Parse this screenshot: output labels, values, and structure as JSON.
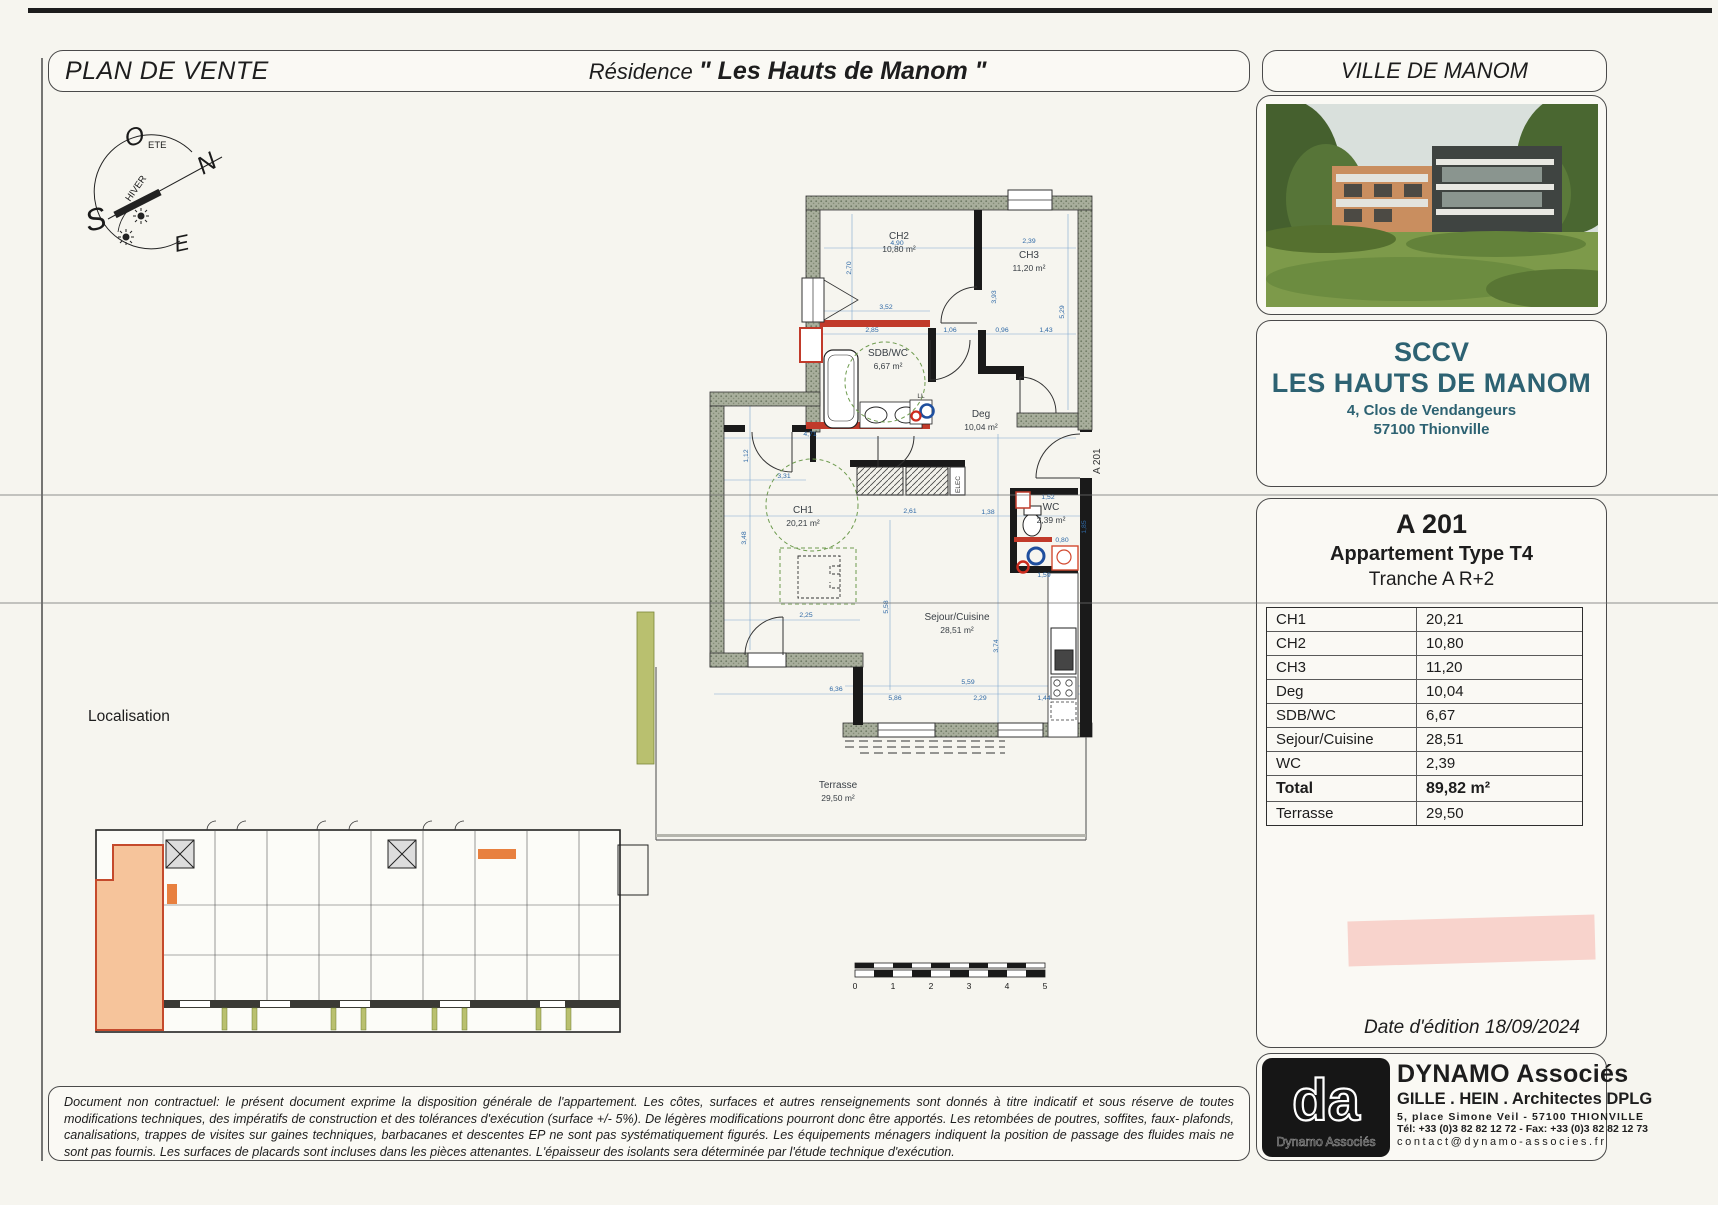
{
  "header": {
    "plan_title": "PLAN DE VENTE",
    "residence_prefix": "Résidence",
    "residence_name": "\" Les Hauts de Manom \"",
    "city_box": "VILLE DE MANOM"
  },
  "developer": {
    "line1": "SCCV",
    "line2": "LES HAUTS DE MANOM",
    "address1": "4, Clos de Vendangeurs",
    "address2": "57100 Thionville",
    "accent_color": "#2d6272"
  },
  "unit": {
    "code": "A 201",
    "type_label": "Appartement Type T4",
    "tranche": "Tranche A R+2"
  },
  "areas": {
    "rows": [
      {
        "label": "CH1",
        "value": "20,21"
      },
      {
        "label": "CH2",
        "value": "10,80"
      },
      {
        "label": "CH3",
        "value": "11,20"
      },
      {
        "label": "Deg",
        "value": "10,04"
      },
      {
        "label": "SDB/WC",
        "value": "6,67"
      },
      {
        "label": "Sejour/Cuisine",
        "value": "28,51"
      },
      {
        "label": "WC",
        "value": "2,39"
      },
      {
        "label": "Total",
        "value": "89,82 m²"
      },
      {
        "label": "Terrasse",
        "value": "29,50"
      }
    ]
  },
  "edition": {
    "date_text": "Date d'édition 18/09/2024"
  },
  "architect": {
    "logo_text": "da",
    "logo_sub": "Dynamo Associés",
    "name": "DYNAMO Associés",
    "partners": "GILLE . HEIN . Architectes DPLG",
    "address": "5, place Simone Veil - 57100 THIONVILLE",
    "phone": "Tél: +33 (0)3 82 82 12 72 - Fax: +33 (0)3 82 82 12 73",
    "email": "contact@dynamo-associes.fr"
  },
  "disclaimer": "Document non contractuel: le présent document exprime la disposition générale de l'appartement. Les côtes, surfaces et autres renseignements sont donnés à titre indicatif et sous réserve de toutes modifications techniques, des impératifs de construction et des tolérances d'exécution (surface +/- 5%). De légères modifications pourront donc être apportés. Les retombées de poutres, soffites, faux- plafonds, canalisations, trappes de visites sur gaines techniques, barbacanes et descentes EP ne sont pas systématiquement figurés. Les équipements ménagers indiquent la position de passage des fluides mais ne sont pas fournis. Les surfaces de placards sont incluses dans les pièces attenantes. L'épaisseur des isolants sera déterminée par l'étude technique d'exécution.",
  "localisation_label": "Localisation",
  "compass": {
    "n": "N",
    "s": "S",
    "e": "E",
    "o": "O",
    "summer": "ETE",
    "winter": "HIVER"
  },
  "plan": {
    "unit_label": "A 201",
    "elec_label": "ELEC",
    "ll_label": "LL",
    "rooms": [
      {
        "name": "CH2",
        "area": "10,80 m²",
        "x": 899,
        "y": 239
      },
      {
        "name": "CH3",
        "area": "11,20 m²",
        "x": 1029,
        "y": 258
      },
      {
        "name": "SDB/WC",
        "area": "6,67 m²",
        "x": 888,
        "y": 356
      },
      {
        "name": "Deg",
        "area": "10,04 m²",
        "x": 981,
        "y": 417
      },
      {
        "name": "CH1",
        "area": "20,21 m²",
        "x": 803,
        "y": 513
      },
      {
        "name": "WC",
        "area": "2,39 m²",
        "x": 1051,
        "y": 510
      },
      {
        "name": "Sejour/Cuisine",
        "area": "28,51 m²",
        "x": 957,
        "y": 620
      },
      {
        "name": "Terrasse",
        "area": "29,50 m²",
        "x": 838,
        "y": 788
      }
    ],
    "dims": [
      {
        "t": "4,90",
        "x": 897,
        "y": 245
      },
      {
        "t": "2,70",
        "x": 851,
        "y": 268,
        "r": -90
      },
      {
        "t": "3,52",
        "x": 886,
        "y": 309
      },
      {
        "t": "2,85",
        "x": 872,
        "y": 332
      },
      {
        "t": "1,06",
        "x": 950,
        "y": 332
      },
      {
        "t": "0,96",
        "x": 1002,
        "y": 332
      },
      {
        "t": "1,43",
        "x": 1046,
        "y": 332
      },
      {
        "t": "2,39",
        "x": 1029,
        "y": 243
      },
      {
        "t": "3,93",
        "x": 996,
        "y": 297,
        "r": -90
      },
      {
        "t": "5,29",
        "x": 1064,
        "y": 312,
        "r": -90
      },
      {
        "t": "4,71",
        "x": 810,
        "y": 436
      },
      {
        "t": "1,12",
        "x": 748,
        "y": 456,
        "r": -90
      },
      {
        "t": "3,31",
        "x": 784,
        "y": 478
      },
      {
        "t": "3,48",
        "x": 746,
        "y": 538,
        "r": -90
      },
      {
        "t": "2,25",
        "x": 806,
        "y": 617
      },
      {
        "t": "2,61",
        "x": 910,
        "y": 513
      },
      {
        "t": "1,38",
        "x": 988,
        "y": 514
      },
      {
        "t": "5,58",
        "x": 888,
        "y": 607,
        "r": -90
      },
      {
        "t": "3,74",
        "x": 998,
        "y": 646,
        "r": -90
      },
      {
        "t": "1,52",
        "x": 1048,
        "y": 499
      },
      {
        "t": "0,80",
        "x": 1062,
        "y": 542
      },
      {
        "t": "1,85",
        "x": 1086,
        "y": 527,
        "r": -90
      },
      {
        "t": "1,59",
        "x": 1044,
        "y": 577
      },
      {
        "t": "6,36",
        "x": 836,
        "y": 691
      },
      {
        "t": "5,86",
        "x": 895,
        "y": 700
      },
      {
        "t": "2,29",
        "x": 980,
        "y": 700
      },
      {
        "t": "1,44",
        "x": 1044,
        "y": 700
      },
      {
        "t": "5,59",
        "x": 968,
        "y": 684
      }
    ]
  },
  "scale_bar": {
    "labels": [
      "0",
      "1",
      "2",
      "3",
      "4",
      "5"
    ]
  }
}
